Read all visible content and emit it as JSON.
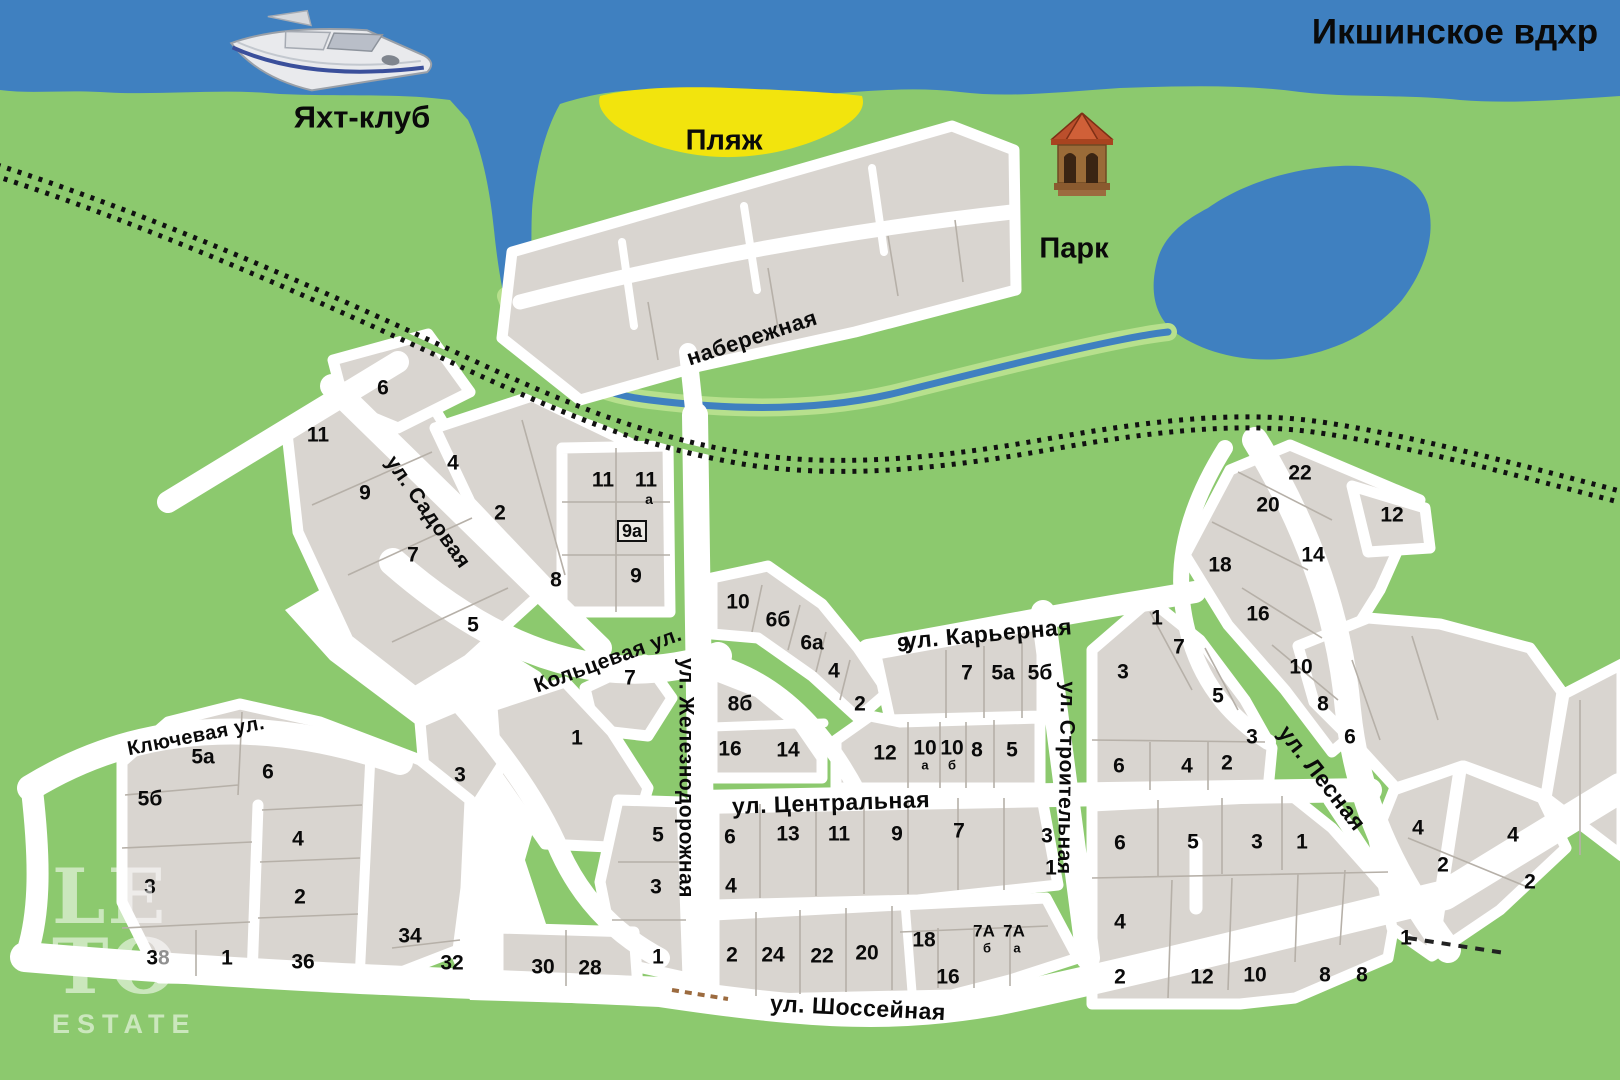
{
  "map": {
    "water_name": "Икшинское вдхр",
    "landmarks": [
      {
        "label": "Икшинское вдхр",
        "x": 1455,
        "y": 32,
        "size": 35
      },
      {
        "label": "Яхт-клуб",
        "x": 362,
        "y": 117,
        "size": 31
      },
      {
        "label": "Пляж",
        "x": 724,
        "y": 141,
        "size": 29
      },
      {
        "label": "Парк",
        "x": 1074,
        "y": 249,
        "size": 29
      }
    ],
    "streets": [
      {
        "label": "набережная",
        "x": 752,
        "y": 338,
        "rot": -18,
        "size": 22
      },
      {
        "label": "ул. Садовая",
        "x": 428,
        "y": 512,
        "rot": 55,
        "size": 21
      },
      {
        "label": "Кольцевая ул.",
        "x": 608,
        "y": 660,
        "rot": -20,
        "size": 21
      },
      {
        "label": "ул. Железнодорожная",
        "x": 686,
        "y": 778,
        "rot": 90,
        "size": 21
      },
      {
        "label": "ул. Центральная",
        "x": 831,
        "y": 803,
        "rot": -2,
        "size": 23
      },
      {
        "label": "ул. Карьерная",
        "x": 988,
        "y": 634,
        "rot": -5,
        "size": 23
      },
      {
        "label": "ул. Строительная",
        "x": 1066,
        "y": 778,
        "rot": 91,
        "size": 21
      },
      {
        "label": "ул. Лесная",
        "x": 1322,
        "y": 778,
        "rot": 52,
        "size": 23
      },
      {
        "label": "ул. Шоссейная",
        "x": 858,
        "y": 1008,
        "rot": 3,
        "size": 23
      },
      {
        "label": "Ключевая ул.",
        "x": 196,
        "y": 736,
        "rot": -11,
        "size": 20
      }
    ],
    "plot_numbers": [
      {
        "t": "6",
        "x": 383,
        "y": 388
      },
      {
        "t": "11",
        "x": 318,
        "y": 435
      },
      {
        "t": "9",
        "x": 365,
        "y": 493
      },
      {
        "t": "7",
        "x": 413,
        "y": 555
      },
      {
        "t": "5",
        "x": 473,
        "y": 625
      },
      {
        "t": "4",
        "x": 453,
        "y": 463
      },
      {
        "t": "2",
        "x": 500,
        "y": 513
      },
      {
        "t": "8",
        "x": 556,
        "y": 580
      },
      {
        "t": "11",
        "x": 603,
        "y": 480
      },
      {
        "t": "11",
        "x": 646,
        "y": 480
      },
      {
        "t": "а",
        "x": 649,
        "y": 499,
        "s": 14
      },
      {
        "t": "9а",
        "x": 632,
        "y": 531,
        "s": 18,
        "box": true
      },
      {
        "t": "9",
        "x": 636,
        "y": 576
      },
      {
        "t": "7",
        "x": 630,
        "y": 678
      },
      {
        "t": "1",
        "x": 577,
        "y": 738
      },
      {
        "t": "3",
        "x": 460,
        "y": 775
      },
      {
        "t": "5",
        "x": 658,
        "y": 835
      },
      {
        "t": "3",
        "x": 656,
        "y": 887
      },
      {
        "t": "1",
        "x": 658,
        "y": 957
      },
      {
        "t": "10",
        "x": 738,
        "y": 602
      },
      {
        "t": "6б",
        "x": 778,
        "y": 620
      },
      {
        "t": "6а",
        "x": 812,
        "y": 643
      },
      {
        "t": "4",
        "x": 834,
        "y": 671
      },
      {
        "t": "2",
        "x": 860,
        "y": 704
      },
      {
        "t": "9",
        "x": 903,
        "y": 645
      },
      {
        "t": "7",
        "x": 967,
        "y": 673
      },
      {
        "t": "5а",
        "x": 1003,
        "y": 673
      },
      {
        "t": "5б",
        "x": 1040,
        "y": 673
      },
      {
        "t": "8б",
        "x": 740,
        "y": 704
      },
      {
        "t": "16",
        "x": 730,
        "y": 749
      },
      {
        "t": "14",
        "x": 788,
        "y": 750
      },
      {
        "t": "12",
        "x": 885,
        "y": 753
      },
      {
        "t": "10",
        "x": 925,
        "y": 748
      },
      {
        "t": "а",
        "x": 925,
        "y": 765,
        "s": 13
      },
      {
        "t": "10",
        "x": 952,
        "y": 748
      },
      {
        "t": "б",
        "x": 952,
        "y": 765,
        "s": 13
      },
      {
        "t": "8",
        "x": 977,
        "y": 750
      },
      {
        "t": "5",
        "x": 1012,
        "y": 750
      },
      {
        "t": "6",
        "x": 730,
        "y": 837
      },
      {
        "t": "13",
        "x": 788,
        "y": 834
      },
      {
        "t": "11",
        "x": 839,
        "y": 834
      },
      {
        "t": "9",
        "x": 897,
        "y": 834
      },
      {
        "t": "7",
        "x": 959,
        "y": 831
      },
      {
        "t": "3",
        "x": 1047,
        "y": 836
      },
      {
        "t": "1",
        "x": 1051,
        "y": 868
      },
      {
        "t": "4",
        "x": 731,
        "y": 886
      },
      {
        "t": "2",
        "x": 732,
        "y": 955
      },
      {
        "t": "24",
        "x": 773,
        "y": 955
      },
      {
        "t": "22",
        "x": 822,
        "y": 956
      },
      {
        "t": "20",
        "x": 867,
        "y": 953
      },
      {
        "t": "18",
        "x": 924,
        "y": 940
      },
      {
        "t": "7А",
        "x": 984,
        "y": 931,
        "s": 17
      },
      {
        "t": "7А",
        "x": 1014,
        "y": 931,
        "s": 17
      },
      {
        "t": "б",
        "x": 987,
        "y": 948,
        "s": 13
      },
      {
        "t": "а",
        "x": 1017,
        "y": 948,
        "s": 13
      },
      {
        "t": "16",
        "x": 948,
        "y": 977
      },
      {
        "t": "1",
        "x": 1157,
        "y": 618
      },
      {
        "t": "7",
        "x": 1179,
        "y": 647
      },
      {
        "t": "3",
        "x": 1123,
        "y": 672
      },
      {
        "t": "5",
        "x": 1218,
        "y": 696
      },
      {
        "t": "3",
        "x": 1252,
        "y": 737
      },
      {
        "t": "6",
        "x": 1119,
        "y": 766
      },
      {
        "t": "4",
        "x": 1187,
        "y": 766
      },
      {
        "t": "2",
        "x": 1227,
        "y": 763
      },
      {
        "t": "22",
        "x": 1300,
        "y": 473
      },
      {
        "t": "20",
        "x": 1268,
        "y": 505
      },
      {
        "t": "18",
        "x": 1220,
        "y": 565
      },
      {
        "t": "14",
        "x": 1313,
        "y": 555
      },
      {
        "t": "16",
        "x": 1258,
        "y": 614
      },
      {
        "t": "12",
        "x": 1392,
        "y": 515
      },
      {
        "t": "10",
        "x": 1301,
        "y": 667
      },
      {
        "t": "8",
        "x": 1323,
        "y": 704
      },
      {
        "t": "6",
        "x": 1350,
        "y": 737
      },
      {
        "t": "6",
        "x": 1120,
        "y": 843
      },
      {
        "t": "5",
        "x": 1193,
        "y": 842
      },
      {
        "t": "3",
        "x": 1257,
        "y": 842
      },
      {
        "t": "1",
        "x": 1302,
        "y": 842
      },
      {
        "t": "4",
        "x": 1120,
        "y": 922
      },
      {
        "t": "2",
        "x": 1120,
        "y": 977
      },
      {
        "t": "12",
        "x": 1202,
        "y": 977
      },
      {
        "t": "10",
        "x": 1255,
        "y": 975
      },
      {
        "t": "8",
        "x": 1325,
        "y": 975
      },
      {
        "t": "8",
        "x": 1362,
        "y": 975
      },
      {
        "t": "4",
        "x": 1418,
        "y": 828
      },
      {
        "t": "2",
        "x": 1443,
        "y": 865
      },
      {
        "t": "4",
        "x": 1513,
        "y": 835
      },
      {
        "t": "2",
        "x": 1530,
        "y": 882
      },
      {
        "t": "1",
        "x": 1406,
        "y": 938
      },
      {
        "t": "5а",
        "x": 203,
        "y": 757
      },
      {
        "t": "6",
        "x": 268,
        "y": 772
      },
      {
        "t": "5б",
        "x": 150,
        "y": 799
      },
      {
        "t": "4",
        "x": 298,
        "y": 839
      },
      {
        "t": "3",
        "x": 150,
        "y": 887
      },
      {
        "t": "2",
        "x": 300,
        "y": 897
      },
      {
        "t": "38",
        "x": 158,
        "y": 958
      },
      {
        "t": "1",
        "x": 227,
        "y": 958
      },
      {
        "t": "36",
        "x": 303,
        "y": 962
      },
      {
        "t": "34",
        "x": 410,
        "y": 936
      },
      {
        "t": "32",
        "x": 452,
        "y": 963
      },
      {
        "t": "30",
        "x": 543,
        "y": 967
      },
      {
        "t": "28",
        "x": 590,
        "y": 968
      }
    ],
    "watermark": {
      "lines": [
        "LE",
        "TO",
        "ESTATE"
      ]
    },
    "icons": [
      "yacht-icon",
      "gazebo-icon"
    ],
    "colors": {
      "water": "#3f80c0",
      "land": "#8cc96e",
      "beach": "#f2e40d",
      "plot": "#d9d5d0",
      "street": "#ffffff",
      "railway": "#111111",
      "label": "#0a0a0a"
    }
  }
}
